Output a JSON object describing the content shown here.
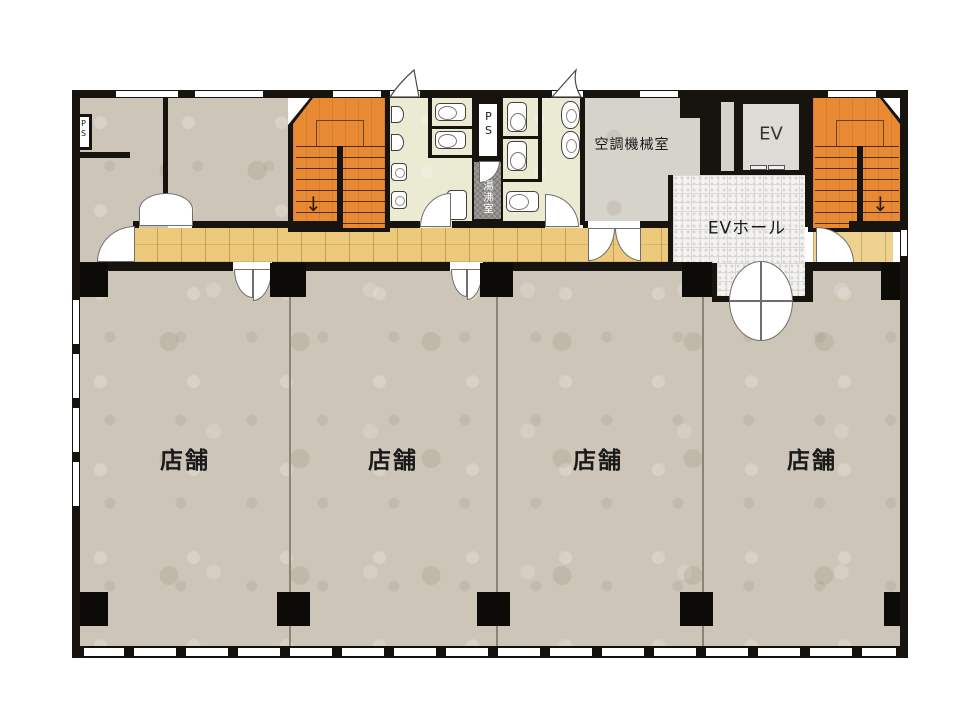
{
  "labels": {
    "shop1": "店舗",
    "shop2": "店舗",
    "shop3": "店舗",
    "shop4": "店舗",
    "machine_room": "空調機械室",
    "elevator": "EV",
    "ev_hall": "EVホール",
    "hot_water_room": "湯沸室",
    "pipe_space": "PS",
    "pipe_space_left": "PS",
    "stair_left_arrow": "↓",
    "stair_right_arrow": "↓"
  },
  "colors": {
    "wall": "#17130e",
    "shop_floor": "#cdc6b8",
    "corridor_wood": "#ecc97b",
    "landing_wood": "#ecd18f",
    "stair_orange": "#e78a33",
    "restroom_floor": "#ebead2",
    "machine_room_gray": "#d6d3cb",
    "hot_water_gray": "#8f8d88",
    "ev_hall_tile": "#f4f3f0",
    "background": "#ffffff"
  }
}
